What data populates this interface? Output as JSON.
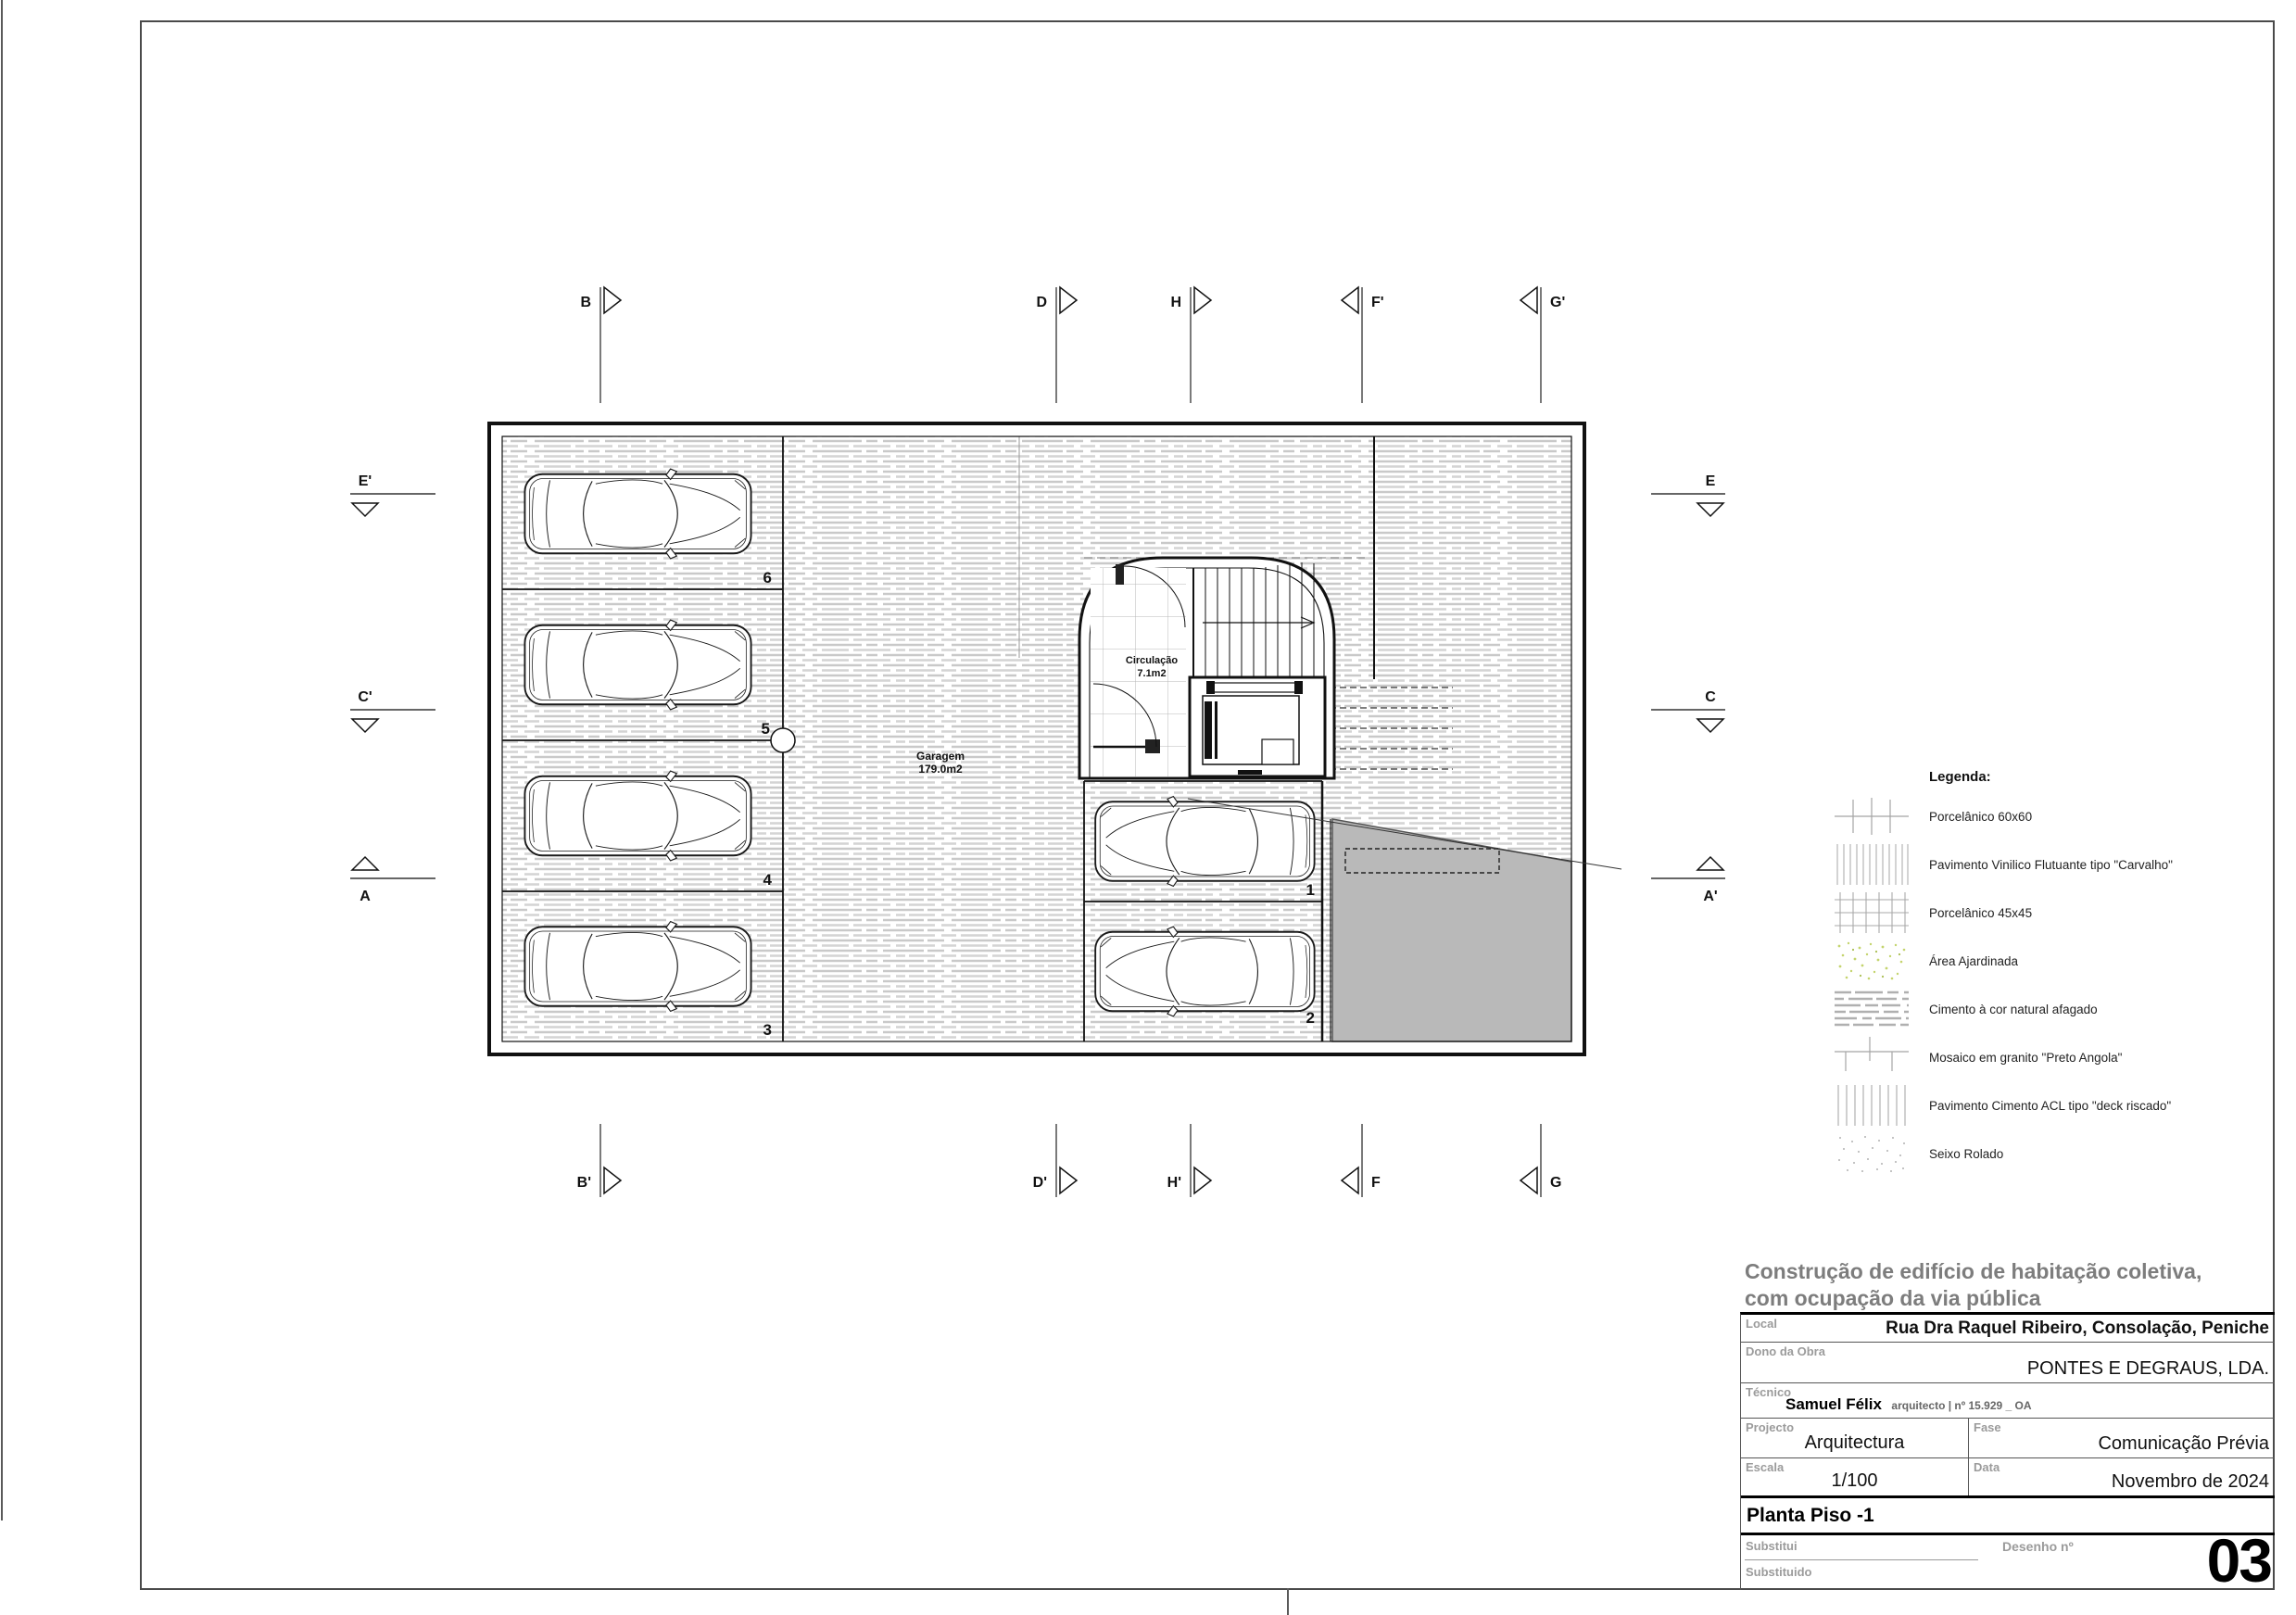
{
  "sheet": {
    "drawing_number": "03",
    "colors": {
      "ramp_gray": "#b9b9b9",
      "hatch_gray": "#c9c9c9",
      "title_gray": "#7d7d7d"
    }
  },
  "plan": {
    "garagem_name": "Garagem",
    "garagem_area": "179.0m2",
    "circulacao_name": "Circulação",
    "circulacao_area": "7.1m2",
    "stalls": [
      "6",
      "5",
      "4",
      "3",
      "1",
      "2"
    ]
  },
  "section_markers": {
    "top": [
      "B",
      "D",
      "H",
      "F'",
      "G'"
    ],
    "bottom": [
      "B'",
      "D'",
      "H'",
      "F",
      "G"
    ],
    "left": [
      "E'",
      "C'",
      "A"
    ],
    "right": [
      "E",
      "C",
      "A'"
    ]
  },
  "legend": {
    "title": "Legenda:",
    "items": [
      {
        "swatch": "grid-sparse-60x60",
        "label": "Porcelânico 60x60"
      },
      {
        "swatch": "vertical-lines-dense",
        "label": "Pavimento Vinilico Flutuante tipo \"Carvalho\""
      },
      {
        "swatch": "grid-dense-45x45",
        "label": "Porcelânico 45x45"
      },
      {
        "swatch": "green-speckle",
        "label": "Área Ajardinada"
      },
      {
        "swatch": "horizontal-streaks",
        "label": "Cimento à cor natural afagado"
      },
      {
        "swatch": "running-bond",
        "label": "Mosaico em granito \"Preto Angola\""
      },
      {
        "swatch": "vertical-lines",
        "label": "Pavimento Cimento ACL tipo \"deck riscado\""
      },
      {
        "swatch": "dot-speckle",
        "label": "Seixo Rolado"
      }
    ]
  },
  "title_block": {
    "project_title_line1": "Construção de edifício de habitação coletiva,",
    "project_title_line2": "com ocupação da via pública",
    "local_label": "Local",
    "local_value": "Rua Dra Raquel Ribeiro, Consolação, Peniche",
    "dono_label": "Dono da Obra",
    "dono_value": "PONTES E DEGRAUS, LDA.",
    "tecnico_label": "Técnico",
    "tecnico_name": "Samuel Félix",
    "tecnico_credentials": "arquitecto | nº 15.929 _ OA",
    "projecto_label": "Projecto",
    "projecto_value": "Arquitectura",
    "fase_label": "Fase",
    "fase_value": "Comunicação Prévia",
    "escala_label": "Escala",
    "escala_value": "1/100",
    "data_label": "Data",
    "data_value": "Novembro de 2024",
    "drawing_title": "Planta Piso -1",
    "substitui_label": "Substitui",
    "substituido_label": "Substituido",
    "desenho_label": "Desenho nº",
    "desenho_value": "03"
  }
}
